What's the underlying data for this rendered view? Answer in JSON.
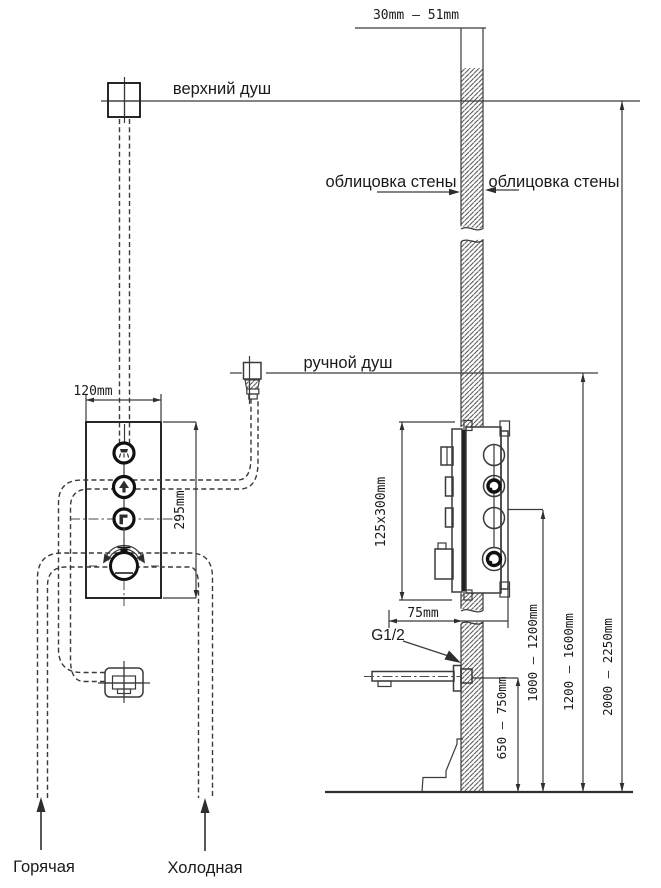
{
  "labels": {
    "wall_thickness": "30mm — 51mm",
    "upper_shower": "верхний душ",
    "cladding_left": "облицовка стены",
    "cladding_right": "облицовка стены",
    "hand_shower": "ручной душ",
    "panel_width": "120mm",
    "panel_height": "295mm",
    "box_dimensions": "125x300mm",
    "wall_to_box": "75mm",
    "thread_size": "G1/2",
    "spout_height": "650 — 750mm",
    "mixer_height": "1000 — 1200mm",
    "hand_shower_height": "1200 — 1600mm",
    "upper_shower_height": "2000 — 2250mm",
    "hot_supply": "Горячая",
    "cold_supply": "Холодная"
  },
  "icons": {
    "panel_button_1": "overhead-shower-icon",
    "panel_button_2": "hand-shower-icon",
    "panel_button_3": "spout-icon",
    "knob": "thermostat-knob-rotation-arrows"
  },
  "colors": {
    "line": "#3a3a3a",
    "bold_line": "#111111",
    "text": "#1a1a1a",
    "background": "#ffffff"
  }
}
